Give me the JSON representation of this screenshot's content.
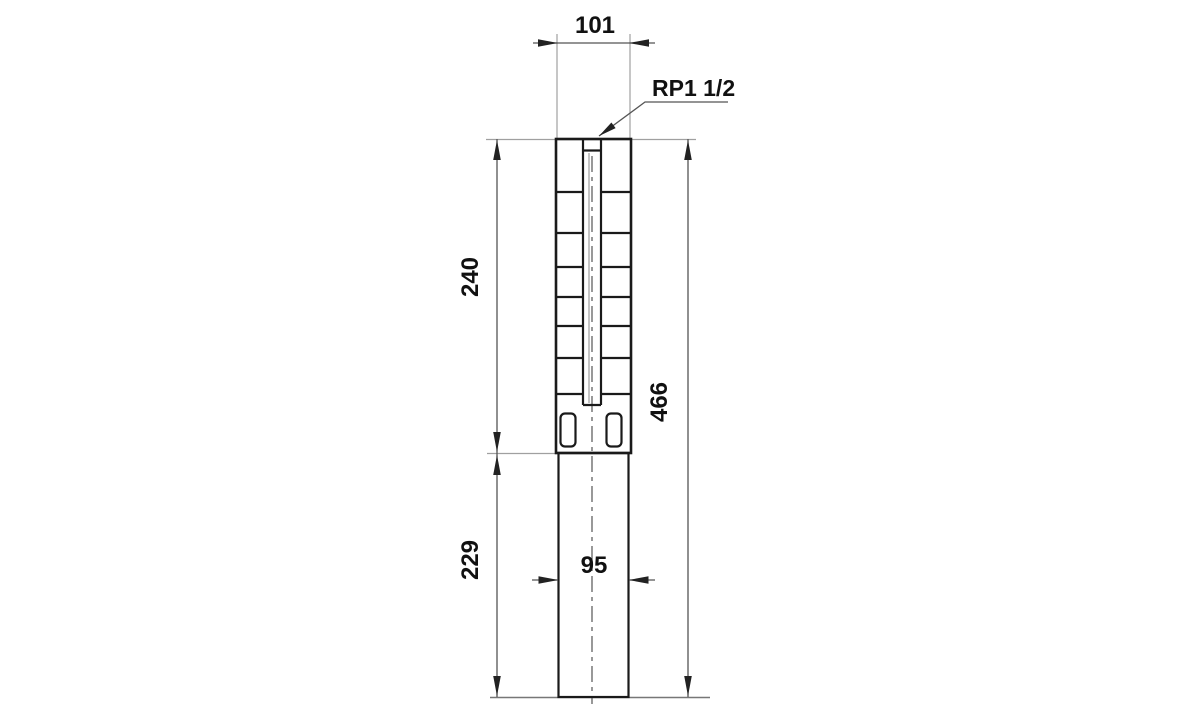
{
  "drawing": {
    "type": "technical-dimensional-drawing",
    "subject": "submersible-borehole-pump-outline",
    "connection_label": "RP1 1/2",
    "dimensions": {
      "top_width": "101",
      "upper_section_height": "240",
      "lower_section_height": "229",
      "total_height": "466",
      "bottom_width": "95"
    },
    "colors": {
      "background": "#ffffff",
      "body_outline": "#1a1a1a",
      "dimension_line": "#555555",
      "extension_line": "#a0a0a0",
      "label_text": "#111111"
    }
  }
}
